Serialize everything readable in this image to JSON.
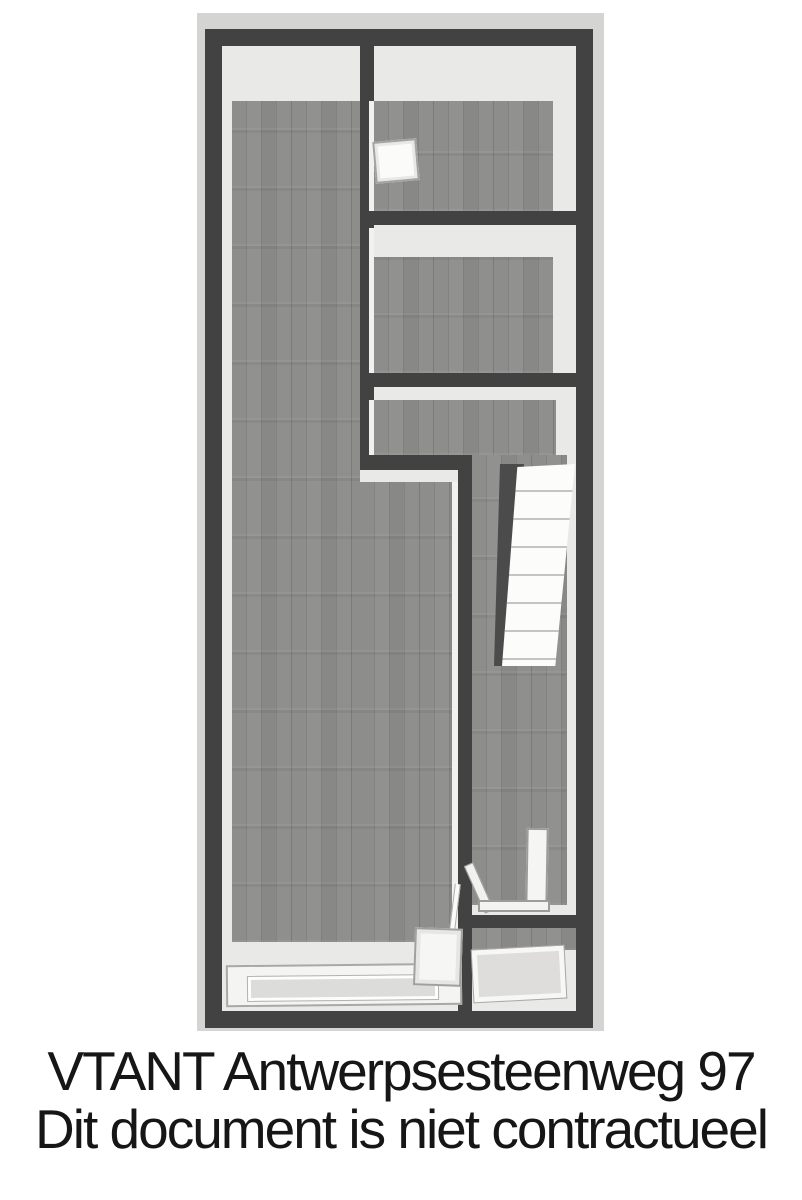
{
  "caption": {
    "line1": "VTANT Antwerpsesteenweg 97",
    "line2": "Dit document is niet contractueel"
  },
  "floorplan": {
    "type": "3d-top-down-floor-plan",
    "elements": [
      "outer-wall",
      "main-room",
      "front-room",
      "middle-room",
      "hallway",
      "staircase",
      "stairwell-shadow",
      "wall-fixture-panel",
      "partition-panels",
      "shower-tray",
      "storefront-window",
      "entrance-door-panel",
      "back-room"
    ],
    "colors": {
      "page_background": "#ffffff",
      "plan_backdrop": "#d4d4d3",
      "wall": "#424242",
      "wall_face": "#e9e9e7",
      "wood_floor": "#898987",
      "stairs": "#fcfcfb",
      "fixture_white": "#f5f5f3",
      "caption_text": "#161616"
    }
  }
}
